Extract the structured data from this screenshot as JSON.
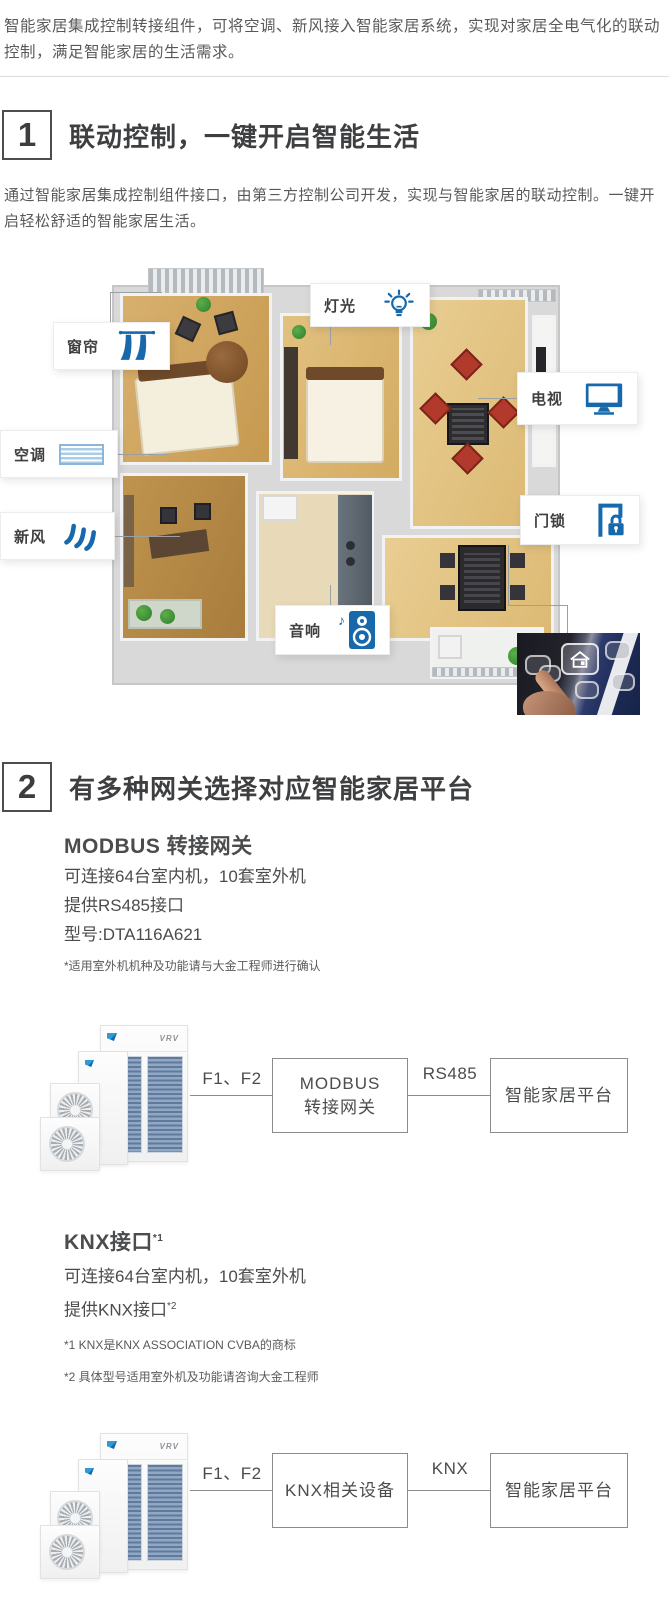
{
  "colors": {
    "accent_blue": "#1769ac",
    "title_gray": "#3e3f41",
    "body_gray": "#58595b"
  },
  "intro": "智能家居集成控制转接组件，可将空调、新风接入智能家居系统，实现对家居全电气化的联动控制，满足智能家居的生活需求。",
  "section1": {
    "number": "1",
    "title": "联动控制，一键开启智能生活",
    "description": "通过智能家居集成控制组件接口，由第三方控制公司开发，实现与智能家居的联动控制。一键开启轻松舒适的智能家居生活。"
  },
  "floorplan": {
    "curtain": "窗帘",
    "light": "灯光",
    "tv": "电视",
    "ac": "空调",
    "fresh_air": "新风",
    "door_lock": "门锁",
    "speaker": "音响"
  },
  "section2": {
    "number": "2",
    "title": "有多种网关选择对应智能家居平台",
    "modbus": {
      "heading": "MODBUS 转接网关",
      "spec1": "可连接64台室内机，10套室外机",
      "spec2": "提供RS485接口",
      "spec3": "型号:DTA116A621",
      "footnote": "*适用室外机机种及功能请与大金工程师进行确认"
    },
    "knx": {
      "heading": "KNX接口",
      "heading_sup": "*1",
      "spec1": "可连接64台室内机，10套室外机",
      "spec2": "提供KNX接口",
      "spec2_sup": "*2",
      "footnote1": "*1 KNX是KNX ASSOCIATION CVBA的商标",
      "footnote2": "*2 具体型号适用室外机及功能请咨询大金工程师"
    }
  },
  "diagram_modbus": {
    "wire_label": "F1、F2",
    "gateway_line1": "MODBUS",
    "gateway_line2": "转接网关",
    "bus_label": "RS485",
    "platform_label": "智能家居平台"
  },
  "diagram_knx": {
    "wire_label": "F1、F2",
    "gateway_label": "KNX相关设备",
    "bus_label": "KNX",
    "platform_label": "智能家居平台"
  },
  "device": {
    "logo": "VRV"
  }
}
